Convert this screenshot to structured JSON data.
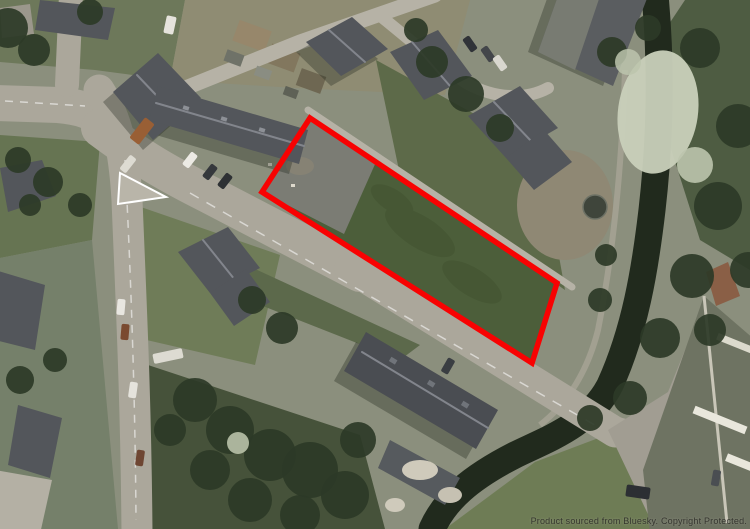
{
  "watermark": {
    "text": "Product sourced from Bluesky. Copyright Protected."
  },
  "site_boundary": {
    "points": "310,118 557,283 532,363 262,192",
    "color": "#f80202",
    "stroke_width": "5.5"
  },
  "site_surfaces": {
    "grass_fill": "#4c5e3a",
    "hardstanding_fill": "#7b7c74",
    "hardstanding_points": "262,192 310,118 376,162 344,234"
  },
  "colors": {
    "boundary_red": "#f80202",
    "site_grass": "#4c5e3a",
    "site_hardstanding": "#7b7c74",
    "road_surface": "#aba79b",
    "roof_slate": "#53565b",
    "canal_water": "#212a1d",
    "tree_canopy": "#2d3927",
    "blossom_tree": "#c9d0ba"
  }
}
